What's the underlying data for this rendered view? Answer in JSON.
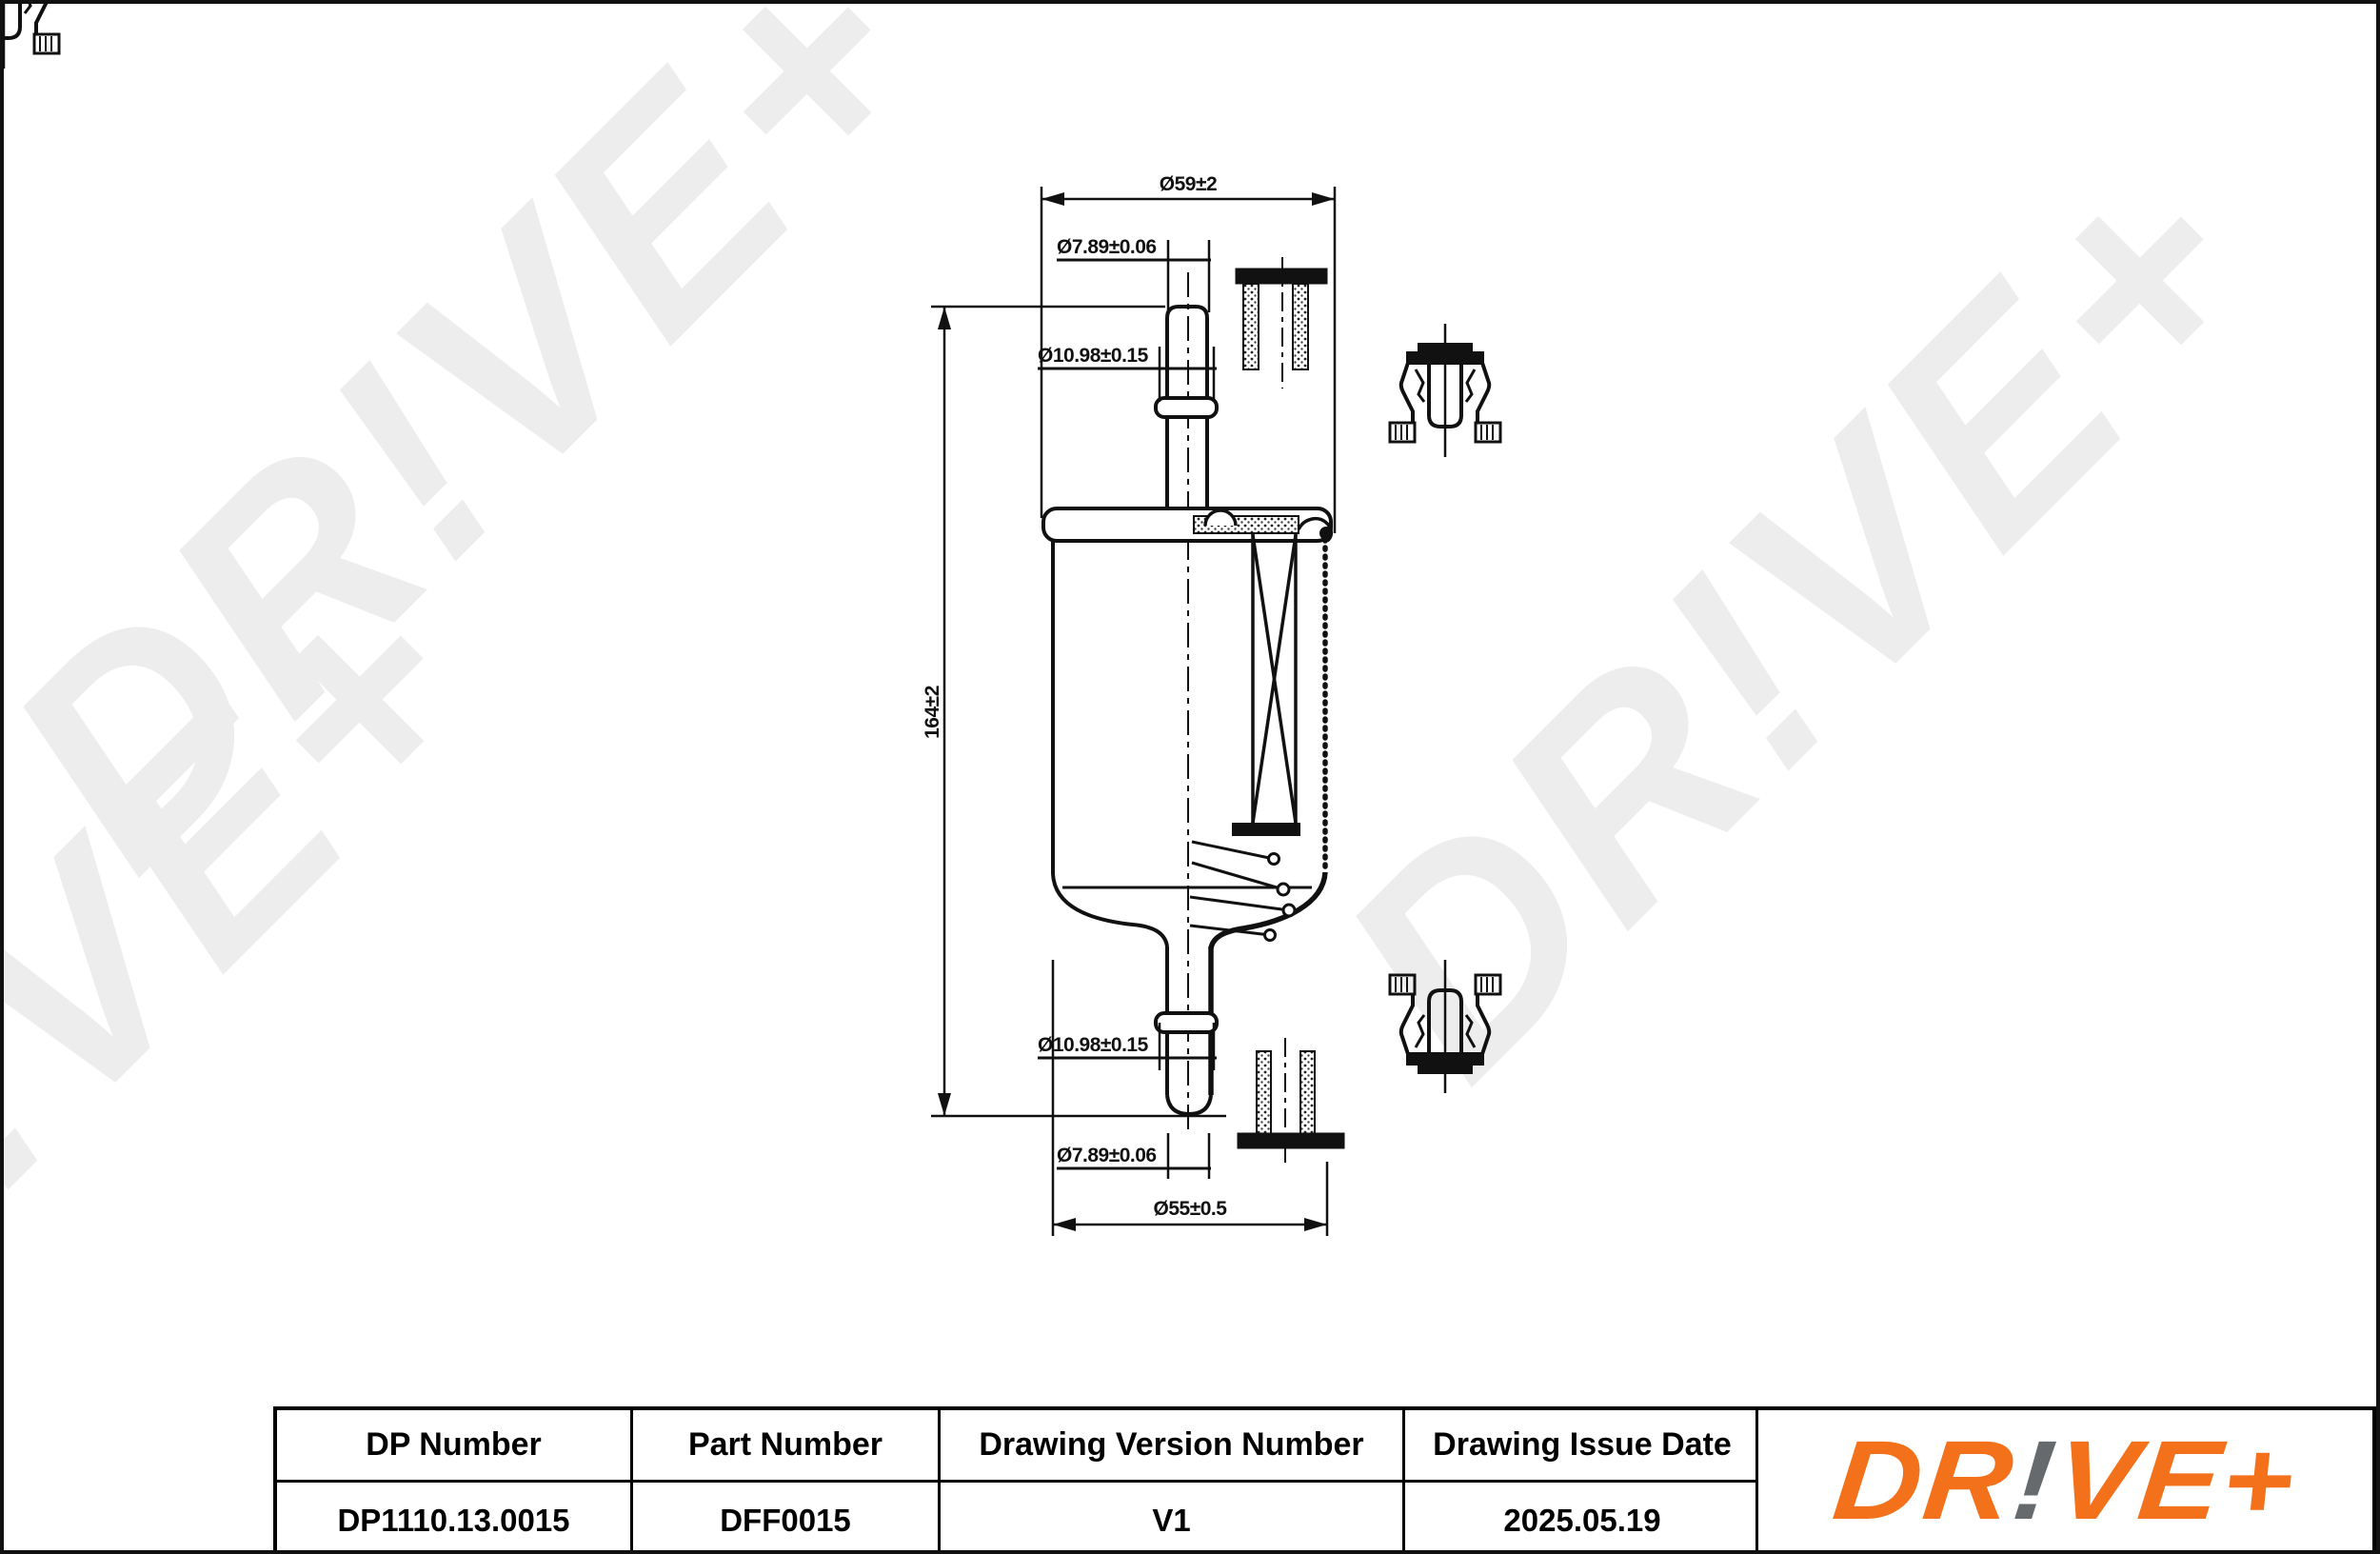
{
  "watermark": {
    "text": "DR!VE+"
  },
  "drawing": {
    "dims": {
      "d59": "Ø59±2",
      "d789_top": "Ø7.89±0.06",
      "d1098_top": "Ø10.98±0.15",
      "h164": "164±2",
      "d1098_bottom": "Ø10.98±0.15",
      "d789_bottom": "Ø7.89±0.06",
      "d55": "Ø55±0.5"
    }
  },
  "title_block": {
    "columns": [
      {
        "header": "DP Number",
        "value": "DP1110.13.0015"
      },
      {
        "header": "Part Number",
        "value": "DFF0015"
      },
      {
        "header": "Drawing Version Number",
        "value": "V1"
      },
      {
        "header": "Drawing Issue Date",
        "value": "2025.05.19"
      }
    ],
    "logo": {
      "part1": "DR",
      "part2": "!",
      "part3": "VE+"
    },
    "colors": {
      "logo_orange": "#F2711A",
      "logo_gray": "#666A6C",
      "line": "#111111"
    }
  }
}
